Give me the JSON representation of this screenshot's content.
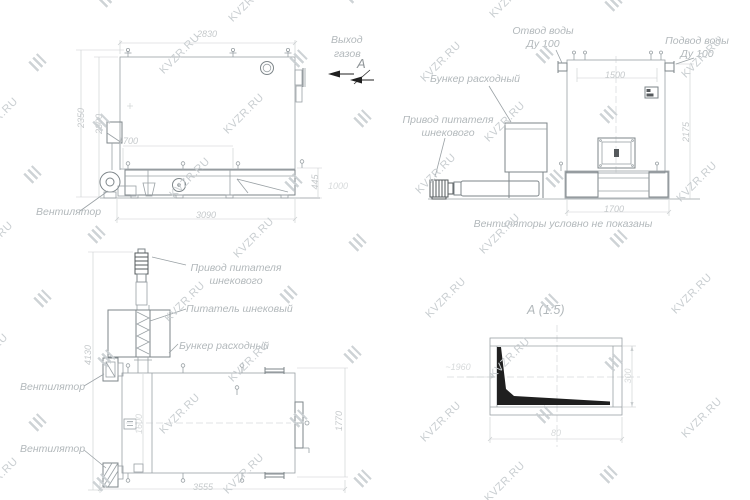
{
  "watermark": {
    "text": "KVZR.RU"
  },
  "colors": {
    "line": "#9aa1a5",
    "dark_line": "#565b5e",
    "dimension": "#c9cdcf",
    "label": "#b2b8bb",
    "black": "#1f1f1f",
    "watermark": "#c9ced1"
  },
  "views": {
    "side": {
      "labels": {
        "fan": "Вентилятор",
        "gas_outlet_line1": "Выход",
        "gas_outlet_line2": "газов",
        "view_arrow": "А"
      },
      "dims": {
        "top_width": "2830",
        "left_outer_height": "2350",
        "left_inner_height": "2300",
        "inner_width": "1700",
        "bottom_width": "3090",
        "right_height": "445",
        "right_offset": "1000"
      }
    },
    "front": {
      "labels": {
        "water_outlet_line1": "Отвод воды",
        "water_outlet_line2": "Ду 100",
        "water_supply_line1": "Подвод воды",
        "water_supply_line2": "Ду 100",
        "hopper": "Бункер расходный",
        "feeder_drive_line1": "Привод питателя",
        "feeder_drive_line2": "шнекового",
        "note": "Вентиляторы условно не показаны"
      },
      "dims": {
        "top_width": "1500",
        "right_height": "2175",
        "bottom_width": "1700"
      }
    },
    "plan": {
      "labels": {
        "feeder_drive_line1": "Привод питателя",
        "feeder_drive_line2": "шнекового",
        "screw_feeder": "Питатель шнековый",
        "hopper": "Бункер расходный",
        "fan_top": "Вентилятор",
        "fan_bottom": "Вентилятор"
      },
      "dims": {
        "left_height": "4130",
        "inner_height": "1600",
        "right_height": "1770",
        "bottom_width": "3555"
      }
    },
    "detail": {
      "title": "А (1:5)",
      "dims": {
        "length": "~1960",
        "height": "300",
        "bottom_width": "80"
      }
    }
  }
}
